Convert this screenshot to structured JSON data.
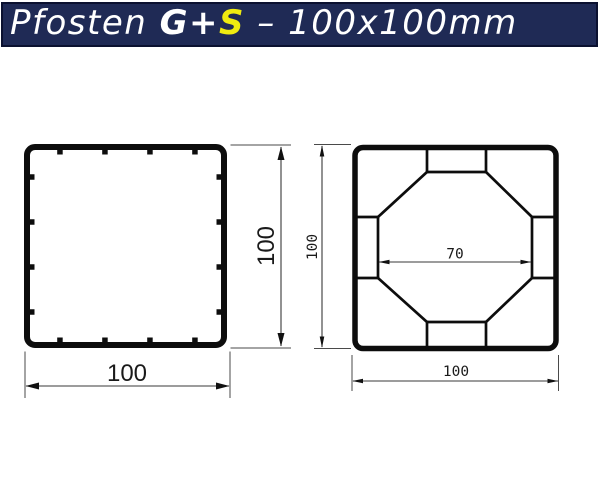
{
  "header": {
    "prefix": "Pfosten ",
    "product_bold": "G+",
    "product_accent": "S",
    "suffix": " – 100x100mm",
    "colors": {
      "background": "#1f2a55",
      "text": "#ffffff",
      "accent_s": "#efeb10",
      "border": "#0b1130"
    }
  },
  "left_drawing": {
    "height_label": "100",
    "width_label": "100"
  },
  "right_drawing": {
    "core_width_label": "70",
    "height_label": "100",
    "width_label": "100"
  },
  "drawing_colors": {
    "profile_line": "#0d0d0d",
    "dimension_line": "#3a3a3a",
    "dimension_text": "#1a1a1a",
    "background": "#ffffff"
  }
}
